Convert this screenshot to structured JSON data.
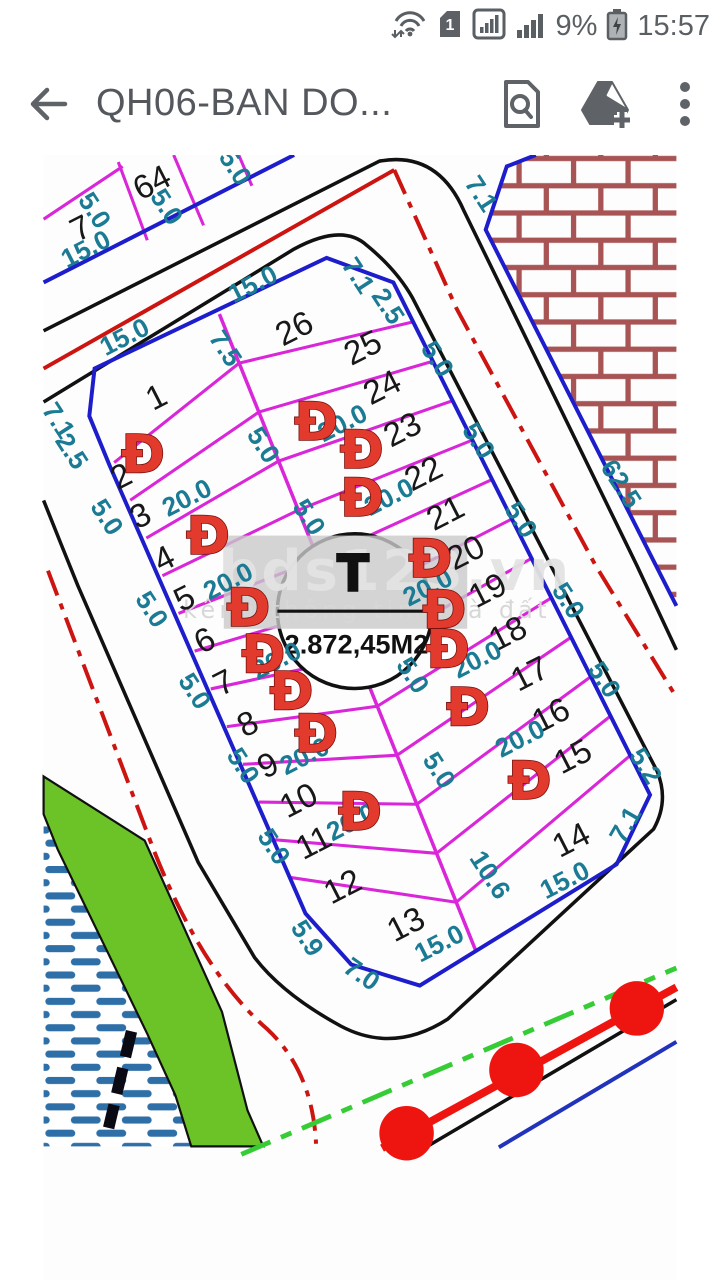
{
  "status_bar": {
    "sim_slot": "1",
    "battery_percent": "9%",
    "time": "15:57"
  },
  "app_bar": {
    "title": "QH06-BAN DO..."
  },
  "map": {
    "stamp": {
      "symbol": "T",
      "area_label": "2.872,45M2"
    },
    "watermark": {
      "brand": "bds123.vn",
      "tagline": "kênh thông tin nhà đất"
    },
    "plot_numbers": [
      {
        "t": "7",
        "x": 42,
        "y": 238,
        "r": -27
      },
      {
        "t": "64",
        "x": 123,
        "y": 186,
        "r": -27
      },
      {
        "t": "1",
        "x": 128,
        "y": 430,
        "r": -27
      },
      {
        "t": "2",
        "x": 88,
        "y": 520,
        "r": -27
      },
      {
        "t": "3",
        "x": 110,
        "y": 565,
        "r": -27
      },
      {
        "t": "4",
        "x": 137,
        "y": 614,
        "r": -27
      },
      {
        "t": "5",
        "x": 160,
        "y": 659,
        "r": -27
      },
      {
        "t": "6",
        "x": 183,
        "y": 707,
        "r": -27
      },
      {
        "t": "7",
        "x": 205,
        "y": 755,
        "r": -27
      },
      {
        "t": "8",
        "x": 232,
        "y": 802,
        "r": -27
      },
      {
        "t": "9",
        "x": 255,
        "y": 849,
        "r": -27
      },
      {
        "t": "10",
        "x": 290,
        "y": 889,
        "r": -27
      },
      {
        "t": "11",
        "x": 307,
        "y": 937,
        "r": -27
      },
      {
        "t": "12",
        "x": 340,
        "y": 987,
        "r": -27
      },
      {
        "t": "13",
        "x": 412,
        "y": 1030,
        "r": -27
      },
      {
        "t": "14",
        "x": 600,
        "y": 934,
        "r": -27
      },
      {
        "t": "15",
        "x": 602,
        "y": 839,
        "r": -27
      },
      {
        "t": "16",
        "x": 577,
        "y": 792,
        "r": -27
      },
      {
        "t": "17",
        "x": 553,
        "y": 745,
        "r": -27
      },
      {
        "t": "18",
        "x": 528,
        "y": 699,
        "r": -27
      },
      {
        "t": "19",
        "x": 505,
        "y": 650,
        "r": -27
      },
      {
        "t": "20",
        "x": 480,
        "y": 607,
        "r": -27
      },
      {
        "t": "21",
        "x": 457,
        "y": 562,
        "r": -27
      },
      {
        "t": "22",
        "x": 432,
        "y": 517,
        "r": -27
      },
      {
        "t": "23",
        "x": 408,
        "y": 467,
        "r": -27
      },
      {
        "t": "24",
        "x": 385,
        "y": 419,
        "r": -27
      },
      {
        "t": "25",
        "x": 363,
        "y": 374,
        "r": -27
      },
      {
        "t": "26",
        "x": 285,
        "y": 352,
        "r": -27
      }
    ],
    "dimension_labels": [
      {
        "t": "15.0",
        "x": 48,
        "y": 262,
        "r": -27
      },
      {
        "t": "5.0",
        "x": 58,
        "y": 218,
        "r": 57
      },
      {
        "t": "5.0",
        "x": 140,
        "y": 214,
        "r": 57
      },
      {
        "t": "5.0",
        "x": 218,
        "y": 169,
        "r": 57
      },
      {
        "t": "15.0",
        "x": 92,
        "y": 362,
        "r": -27
      },
      {
        "t": "15.0",
        "x": 238,
        "y": 302,
        "r": -27
      },
      {
        "t": "7.5",
        "x": 207,
        "y": 375,
        "r": 57
      },
      {
        "t": "7.1",
        "x": 17,
        "y": 457,
        "r": 57
      },
      {
        "t": "2.5",
        "x": 32,
        "y": 492,
        "r": 57
      },
      {
        "t": "7.1",
        "x": 358,
        "y": 292,
        "r": 57
      },
      {
        "t": "2.5",
        "x": 392,
        "y": 327,
        "r": 57
      },
      {
        "t": "7.1",
        "x": 498,
        "y": 199,
        "r": 57
      },
      {
        "t": "62.5",
        "x": 657,
        "y": 529,
        "r": 57
      },
      {
        "t": "5.0",
        "x": 448,
        "y": 387,
        "r": 57
      },
      {
        "t": "5.0",
        "x": 495,
        "y": 480,
        "r": 57
      },
      {
        "t": "5.0",
        "x": 543,
        "y": 570,
        "r": 57
      },
      {
        "t": "5.0",
        "x": 597,
        "y": 662,
        "r": 57
      },
      {
        "t": "5.0",
        "x": 638,
        "y": 752,
        "r": 57
      },
      {
        "t": "5.2",
        "x": 685,
        "y": 850,
        "r": 57
      },
      {
        "t": "7.1",
        "x": 662,
        "y": 917,
        "r": -60
      },
      {
        "t": "15.0",
        "x": 593,
        "y": 980,
        "r": -27
      },
      {
        "t": "15.0",
        "x": 450,
        "y": 1052,
        "r": -27
      },
      {
        "t": "10.6",
        "x": 508,
        "y": 974,
        "r": 57
      },
      {
        "t": "5.9",
        "x": 300,
        "y": 1046,
        "r": 57
      },
      {
        "t": "7.0",
        "x": 362,
        "y": 1087,
        "r": 35
      },
      {
        "t": "5.0",
        "x": 72,
        "y": 567,
        "r": 57
      },
      {
        "t": "5.0",
        "x": 123,
        "y": 672,
        "r": 57
      },
      {
        "t": "5.0",
        "x": 172,
        "y": 765,
        "r": 57
      },
      {
        "t": "5.0",
        "x": 227,
        "y": 850,
        "r": 57
      },
      {
        "t": "5.0",
        "x": 262,
        "y": 942,
        "r": 57
      },
      {
        "t": "5.0",
        "x": 250,
        "y": 485,
        "r": 57
      },
      {
        "t": "5.0",
        "x": 302,
        "y": 567,
        "r": 57
      },
      {
        "t": "5.0",
        "x": 420,
        "y": 747,
        "r": 57
      },
      {
        "t": "5.0",
        "x": 450,
        "y": 855,
        "r": 57
      },
      {
        "t": "20.0",
        "x": 163,
        "y": 545,
        "r": -27
      },
      {
        "t": "20.0",
        "x": 210,
        "y": 640,
        "r": -27
      },
      {
        "t": "20.0",
        "x": 265,
        "y": 730,
        "r": -27
      },
      {
        "t": "20.0",
        "x": 297,
        "y": 839,
        "r": -27
      },
      {
        "t": "20.0",
        "x": 350,
        "y": 914,
        "r": -27
      },
      {
        "t": "20.0",
        "x": 340,
        "y": 460,
        "r": -27
      },
      {
        "t": "20.0",
        "x": 393,
        "y": 544,
        "r": -27
      },
      {
        "t": "20.0",
        "x": 437,
        "y": 647,
        "r": -27
      },
      {
        "t": "20.0",
        "x": 493,
        "y": 729,
        "r": -27
      },
      {
        "t": "20.0",
        "x": 542,
        "y": 819,
        "r": -27
      }
    ],
    "road_markers": {
      "glyph": "Đ",
      "positions": [
        {
          "x": 113,
          "y": 495
        },
        {
          "x": 187,
          "y": 588
        },
        {
          "x": 310,
          "y": 458
        },
        {
          "x": 362,
          "y": 490
        },
        {
          "x": 362,
          "y": 545
        },
        {
          "x": 233,
          "y": 670
        },
        {
          "x": 250,
          "y": 723
        },
        {
          "x": 282,
          "y": 765
        },
        {
          "x": 310,
          "y": 813
        },
        {
          "x": 360,
          "y": 902
        },
        {
          "x": 440,
          "y": 614
        },
        {
          "x": 456,
          "y": 672
        },
        {
          "x": 460,
          "y": 717
        },
        {
          "x": 483,
          "y": 783
        },
        {
          "x": 553,
          "y": 867
        }
      ]
    }
  },
  "colors": {
    "parcel_line": "#d926d9",
    "boundary": "#1d1dcc",
    "dimension": "#1b7b94",
    "road_edge": "#111111",
    "centerline_red": "#cc1410",
    "marker_red": "#e23b2e",
    "green_strip": "#6cc327",
    "green_dash": "#35cc35",
    "water_hatch": "#2e6fa8",
    "brick": "#a85454",
    "utility_red": "#ee1511"
  }
}
